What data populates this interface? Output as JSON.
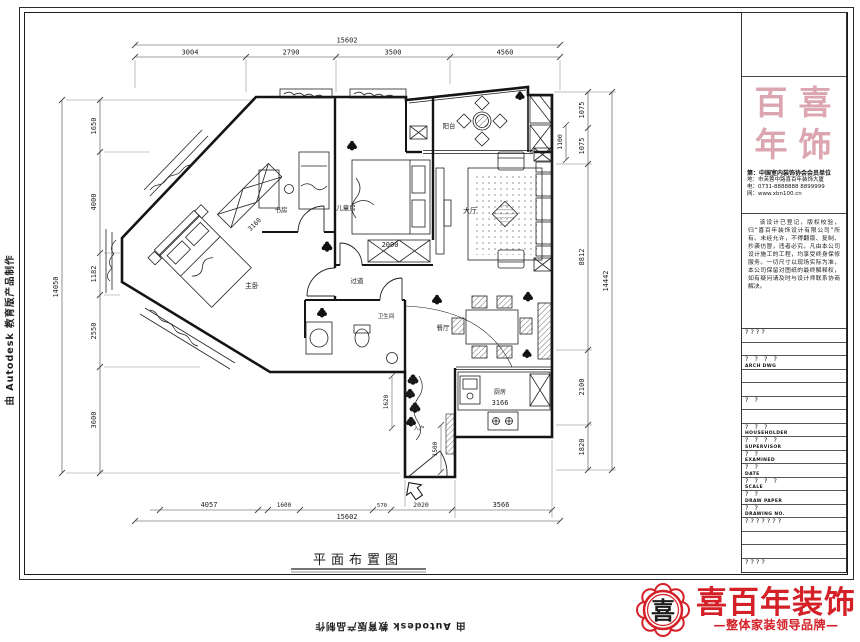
{
  "watermark": {
    "text": "由 Autodesk 教育版产品制作"
  },
  "sheet": {
    "figure_title": "平面布置图"
  },
  "plan": {
    "rooms": {
      "balcony": "阳台",
      "living": "大厅",
      "kids_room": "儿童房",
      "study": "书房",
      "master": "主卧",
      "corridor": "过道",
      "bathroom": "卫生间",
      "dining": "餐厅",
      "kitchen": "厨房",
      "entry": "入户"
    },
    "dims": {
      "top_total": "15602",
      "top": [
        "3004",
        "2790",
        "3500",
        "4560"
      ],
      "bottom": [
        "4057",
        "1600",
        "570",
        "2020",
        "3566"
      ],
      "bottom_total": "15602",
      "left": [
        "1650",
        "4000",
        "1182",
        "2550",
        "3600"
      ],
      "left_total": "14050",
      "right": [
        "1075",
        "1075",
        "8812",
        "2100",
        "1820"
      ],
      "right_total": "14442",
      "balcony_depth": "1100",
      "kids_bed": "2000",
      "master_width": "3160",
      "kitchen_counter": "3166",
      "entry_width": "1620",
      "entry_depth": "1500"
    }
  },
  "titleblock": {
    "seal_chars": [
      "百",
      "喜",
      "年",
      "饰"
    ],
    "contact": [
      "第：中国室内装饰协会会员单位",
      "地：市芙蓉中路喜百年装饰大厦",
      "电：0731-8888888  8899999",
      "网：www.xbn100.cn"
    ],
    "statement": "该设计已登记，版权校验，归“喜百年装饰设计有限公司”所有。未经允许，不得翻版、复制、抄袭仿冒，违者必究。凡由本公司设计施工的工程，均享受终身保修服务。一切尺寸以现场实际为准，本公司保留对图纸的最终解释权，如有疑问请及时与设计师联系协商解决。",
    "rows": [
      {
        "cn": "????",
        "en": ""
      },
      {
        "cn": "",
        "en": ""
      },
      {
        "cn": "? ? ? ?",
        "en": "ARCH DWG"
      },
      {
        "cn": "",
        "en": ""
      },
      {
        "cn": "",
        "en": ""
      },
      {
        "cn": "? ?",
        "en": ""
      },
      {
        "cn": "",
        "en": ""
      },
      {
        "cn": "? ? ?",
        "en": "HOUSEHOLDER"
      },
      {
        "cn": "? ? ? ?",
        "en": "SUPERVISOR"
      },
      {
        "cn": "? ?",
        "en": "EXAMINED"
      },
      {
        "cn": "? ?",
        "en": "DATE"
      },
      {
        "cn": "? ? ? ?",
        "en": "SCALE"
      },
      {
        "cn": "? ?",
        "en": "DRAW PAPER"
      },
      {
        "cn": "? ?",
        "en": "DRAWING NO."
      },
      {
        "cn": "???????",
        "en": ""
      },
      {
        "cn": "",
        "en": ""
      },
      {
        "cn": "",
        "en": ""
      },
      {
        "cn": "????",
        "en": ""
      }
    ]
  },
  "logo": {
    "name": "喜百年装饰",
    "tagline": "—整体家装领导品牌—",
    "seal_char": "喜",
    "color": "#d42027"
  }
}
